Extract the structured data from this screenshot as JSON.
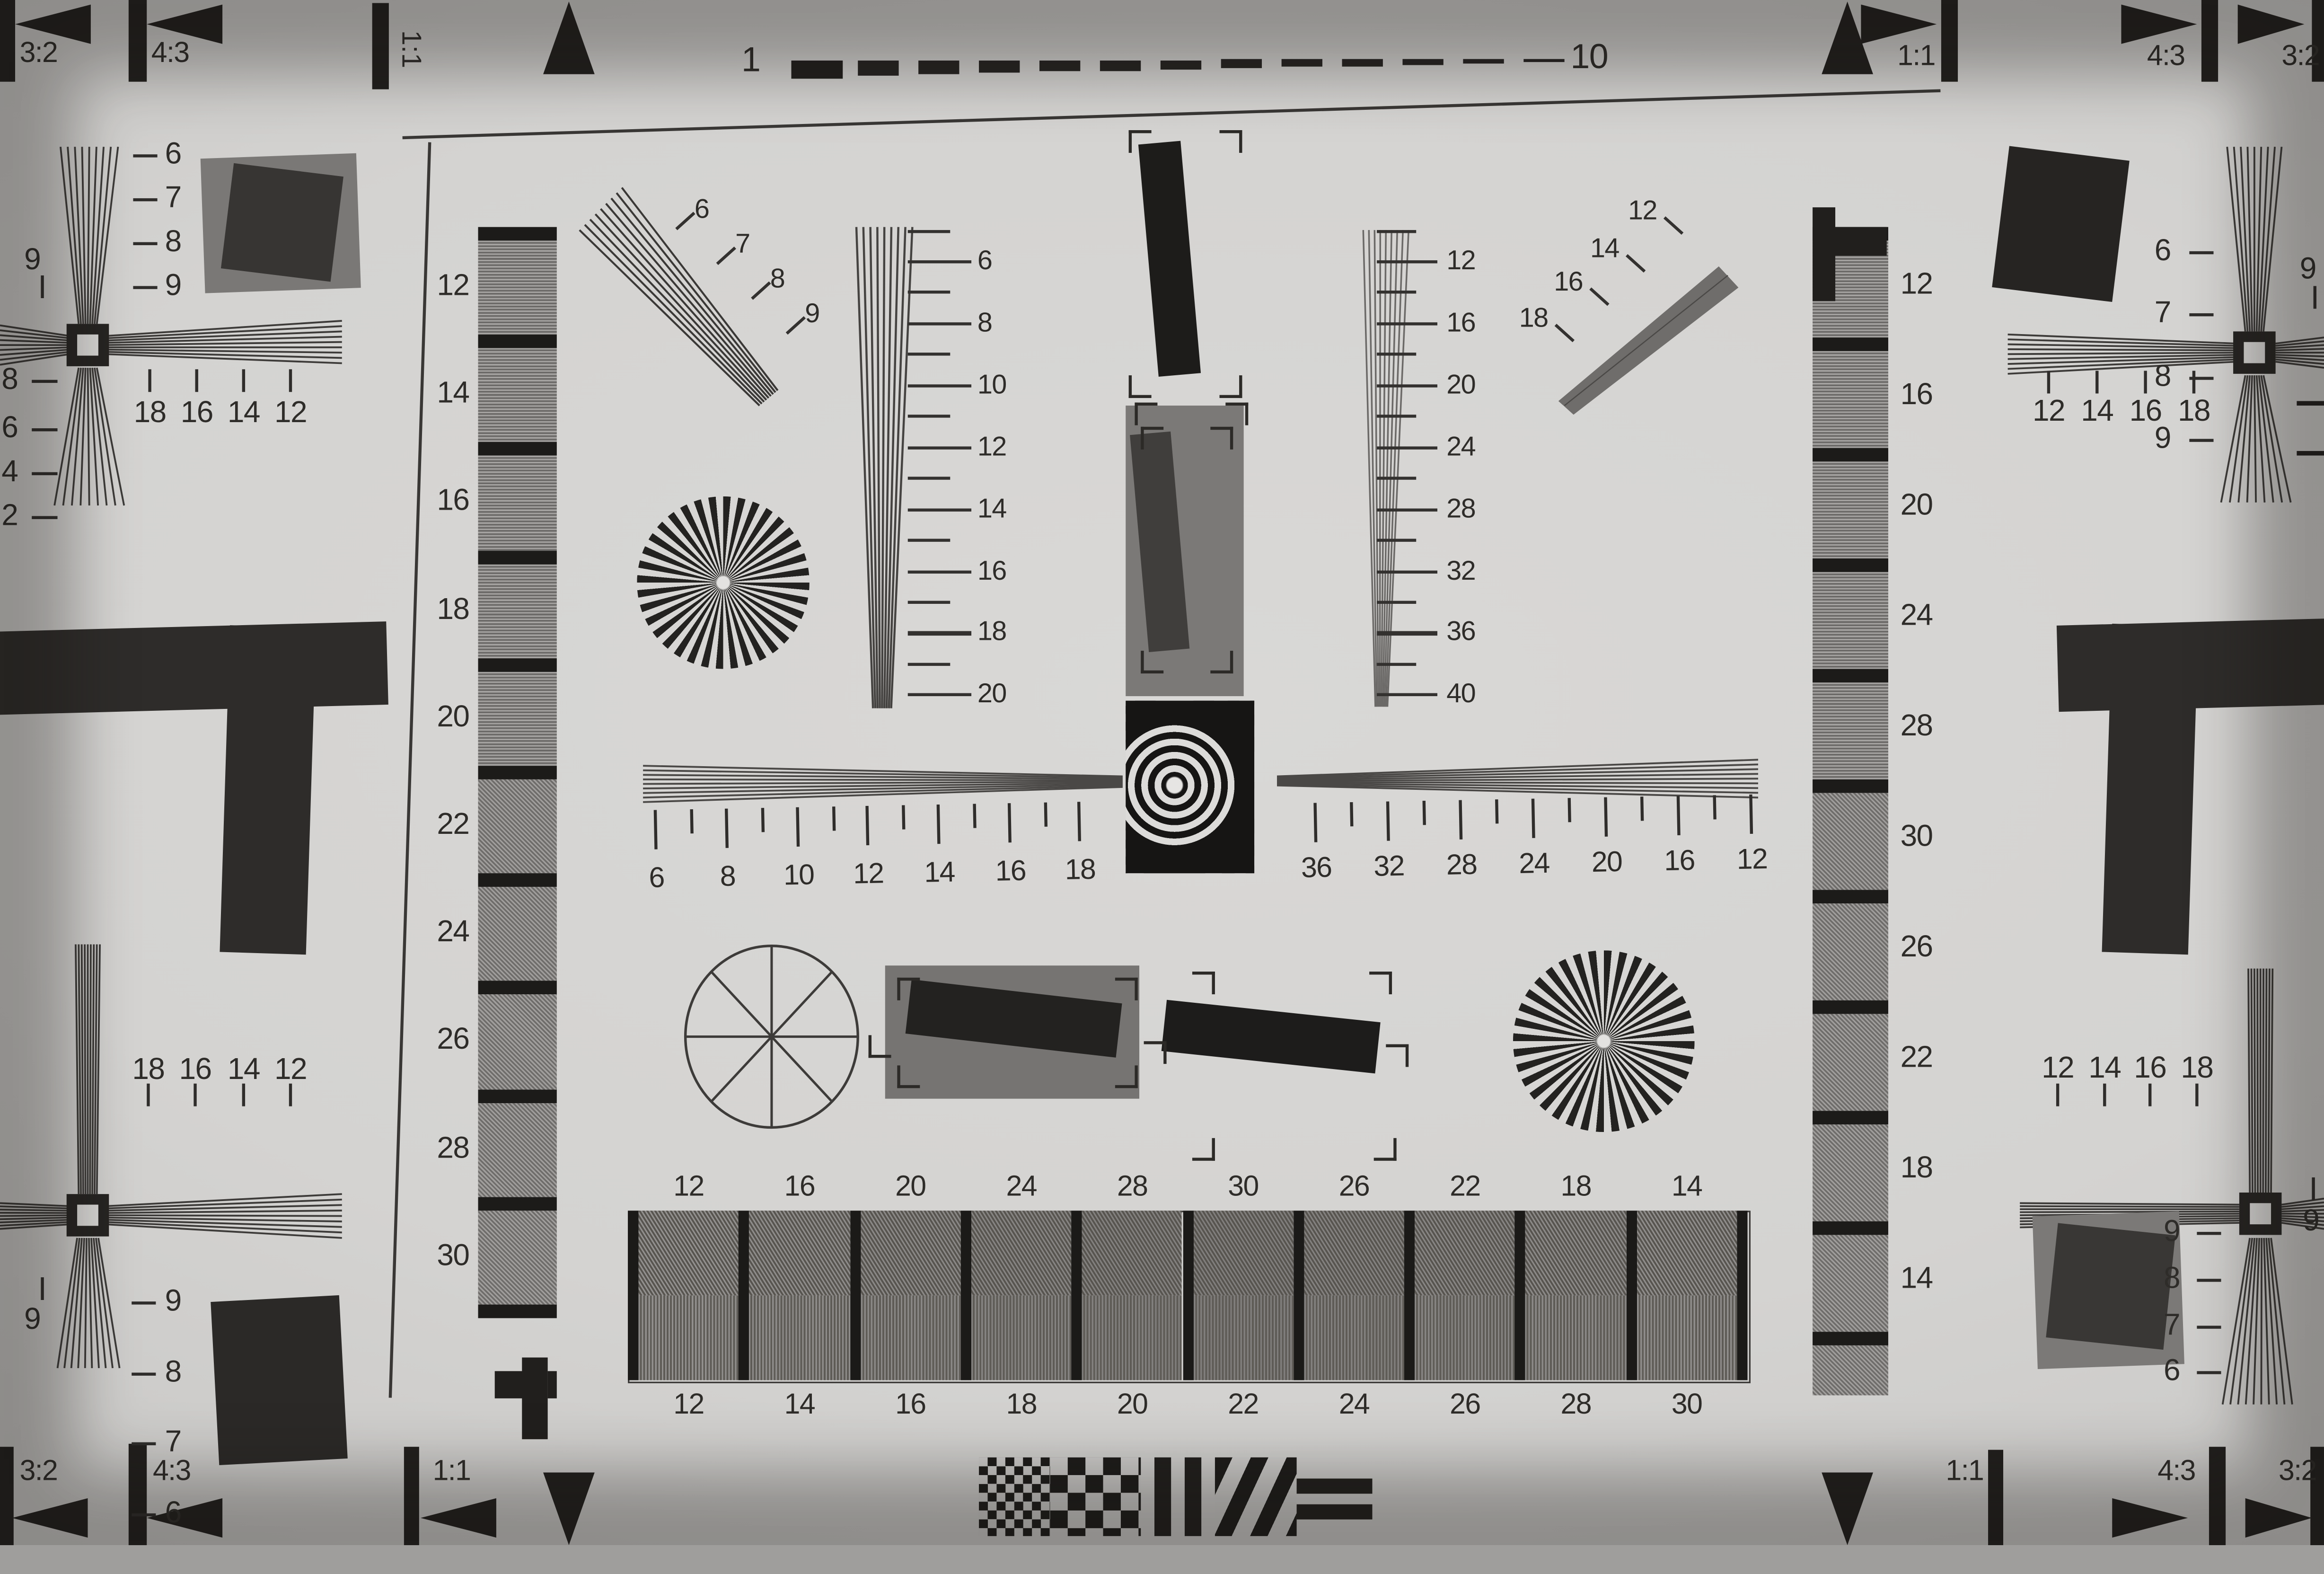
{
  "corners": {
    "top_left": {
      "r32": "3:2",
      "r43": "4:3",
      "r11": "1:1"
    },
    "top_right": {
      "r11": "1:1",
      "r43": "4:3",
      "r32": "3:2"
    },
    "bottom_left": {
      "r32": "3:2",
      "r43": "4:3",
      "r11": "1:1"
    },
    "bottom_right": {
      "r11": "1:1",
      "r43": "4:3",
      "r32": "3:2"
    }
  },
  "top_ruler": {
    "start": "1",
    "end": "10"
  },
  "scales": {
    "tl_diag": [
      "6",
      "7",
      "8",
      "9"
    ],
    "tr_diag": [
      "12",
      "14",
      "16",
      "18"
    ],
    "center_left_wedge": [
      "6",
      "8",
      "10",
      "12",
      "14",
      "16",
      "18",
      "20"
    ],
    "center_right_wedge": [
      "12",
      "16",
      "20",
      "24",
      "28",
      "32",
      "36",
      "40"
    ],
    "h_left": [
      "6",
      "8",
      "10",
      "12",
      "14",
      "16",
      "18"
    ],
    "h_right": [
      "36",
      "32",
      "28",
      "24",
      "20",
      "16",
      "12"
    ],
    "left_strip": [
      "12",
      "14",
      "16",
      "18",
      "20",
      "22",
      "24",
      "26",
      "28",
      "30"
    ],
    "right_strip": [
      "12",
      "16",
      "20",
      "24",
      "28",
      "30",
      "26",
      "22",
      "18",
      "14"
    ],
    "tablet_top": [
      "12",
      "16",
      "20",
      "24",
      "28",
      "30",
      "26",
      "22",
      "18",
      "14"
    ],
    "tablet_bottom": [
      "12",
      "14",
      "16",
      "18",
      "20",
      "22",
      "24",
      "26",
      "28",
      "30"
    ],
    "tl_tickrow": [
      "18",
      "16",
      "14",
      "12"
    ],
    "bl_tickrow": [
      "18",
      "16",
      "14",
      "12"
    ],
    "tr_tickrow": [
      "12",
      "14",
      "16",
      "18"
    ],
    "br_tickrow": [
      "12",
      "14",
      "16",
      "18"
    ],
    "tl_edge_wedge": [
      "6",
      "7",
      "8",
      "9"
    ],
    "bl_edge_wedge": [
      "9",
      "8",
      "7",
      "6"
    ],
    "tr_edge_wedge": [
      "6",
      "7",
      "8",
      "9"
    ],
    "br_edge_wedge": [
      "9",
      "8",
      "7",
      "6"
    ],
    "left_edge_cut": [
      "8",
      "6",
      "4",
      "2"
    ],
    "edge_nine": "9"
  }
}
